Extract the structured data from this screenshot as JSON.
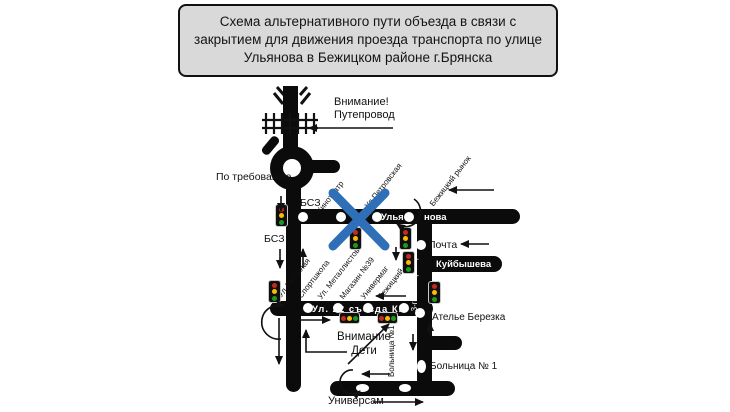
{
  "title": "Схема альтернативного пути объезда в связи с закрытием для движения проезда транспорта по улице Ульянова в Бежицком районе г.Брянска",
  "colors": {
    "road": "#0b0b0b",
    "closure_x": "#2e6fb7",
    "panel_bg": "#d9d9d9",
    "light_red": "#c42b1c",
    "light_yellow": "#ffb900",
    "light_green": "#1d9a1d"
  },
  "map": {
    "warnings": {
      "overpass": "Внимание! Путепровод",
      "children_line1": "Внимание",
      "children_line2": "Дети"
    },
    "stops": {
      "on_demand": "По требованию"
    },
    "places": {
      "bsz_upper": "БСЗ",
      "bsz_lower": "БСЗ",
      "cinema": "Кинотеатр",
      "market": "Бежицкий рынок",
      "post": "Почта",
      "atelier": "Ателье Березка",
      "hospital_sign": "Больница № 1",
      "hospital_street": "Больница №1",
      "supermarket": "Универсам",
      "sport_school": "Спортшкола",
      "shop_39": "Магазин №39",
      "department_store": "Универмаг",
      "department_store_2": "Бежицкий"
    },
    "streets": {
      "ulyanova_prefix": "Ул.",
      "ulyanova_mid": "Улья",
      "ulyanova_suffix": "нова",
      "petrovskaya": "Ул Петровская",
      "liteynaya": "Ул.Литейная",
      "metallistov": "Ул. Металлистов",
      "szezda": "Ул. 22 съезда КП",
      "kuibysheva": "Куйбышева",
      "internatsionala": "Ул. 3-го Интернационала"
    }
  }
}
